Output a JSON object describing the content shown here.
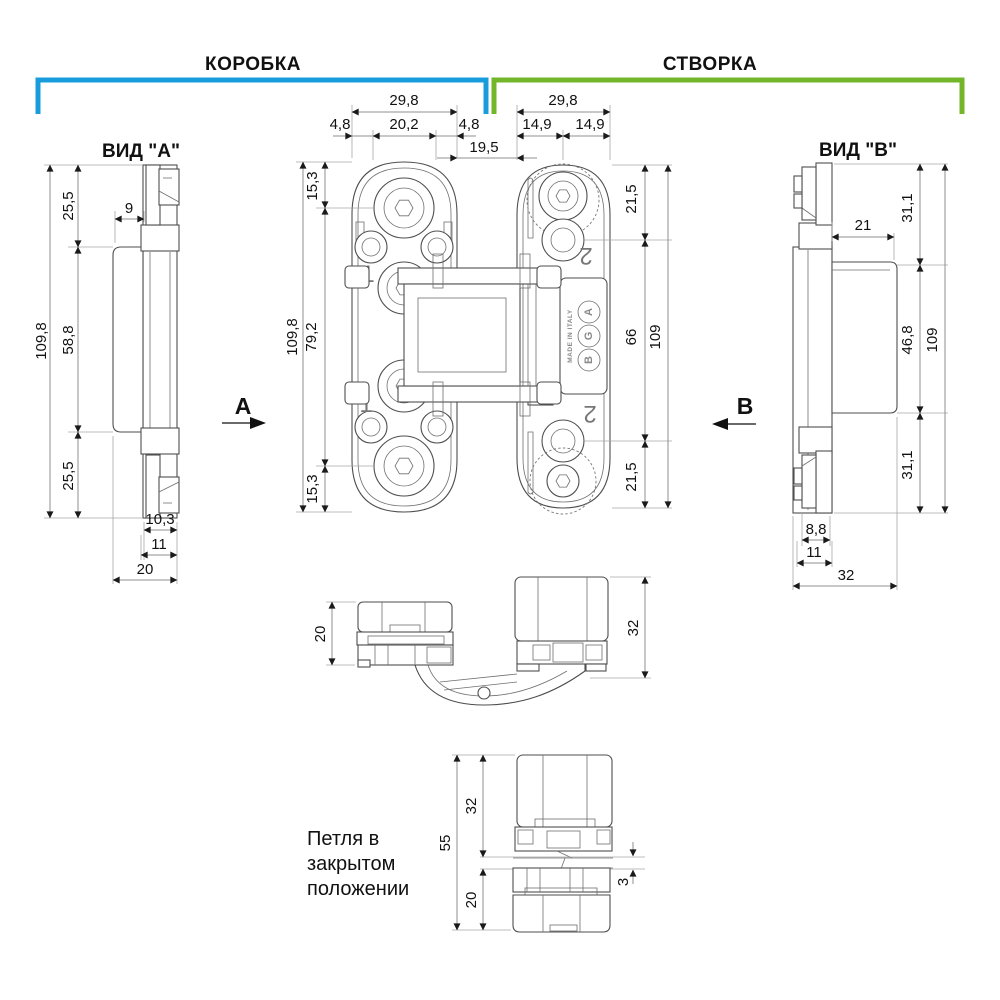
{
  "header": {
    "frame_label": "КОРОБКА",
    "leaf_label": "СТВОРКА",
    "frame_bracket_color": "#189cdb",
    "leaf_bracket_color": "#73b629"
  },
  "view_a": {
    "title": "ВИД \"А\"",
    "direction_label": "A",
    "dims": {
      "top": "25,5",
      "offset": "9",
      "total": "109,8",
      "middle": "58,8",
      "bottom": "25,5",
      "cap_width": "10,3",
      "cap_outer": "11",
      "depth": "20"
    }
  },
  "front_view": {
    "gap_dim": "19,5",
    "frame_plate": {
      "marking": "1",
      "dims": {
        "width": "29,8",
        "lip_left": "4,8",
        "inner_width": "20,2",
        "lip_right": "4,8",
        "hole_top": "15,3",
        "length": "109,8",
        "hole_span": "79,2",
        "hole_bottom": "15,3"
      }
    },
    "leaf_plate": {
      "marking": "2",
      "logo_letters": [
        "A",
        "G",
        "B"
      ],
      "made_in": "MADE IN ITALY",
      "dims": {
        "width": "29,8",
        "half_left": "14,9",
        "half_right": "14,9",
        "hole_top": "21,5",
        "hole_span": "66",
        "length": "109",
        "hole_bottom": "21,5"
      }
    }
  },
  "view_b": {
    "title": "ВИД \"В\"",
    "direction_label": "B",
    "dims": {
      "top": "31,1",
      "offset": "21",
      "middle": "46,8",
      "total": "109",
      "bottom": "31,1",
      "cap_width": "8,8",
      "cap_outer": "11",
      "depth": "32"
    }
  },
  "open_view": {
    "dims": {
      "frame_depth": "20",
      "leaf_depth": "32"
    }
  },
  "closed_view": {
    "caption_line1": "Петля в",
    "caption_line2": "закрытом",
    "caption_line3": "положении",
    "dims": {
      "total": "55",
      "leaf": "32",
      "frame": "20",
      "gap": "3"
    }
  }
}
